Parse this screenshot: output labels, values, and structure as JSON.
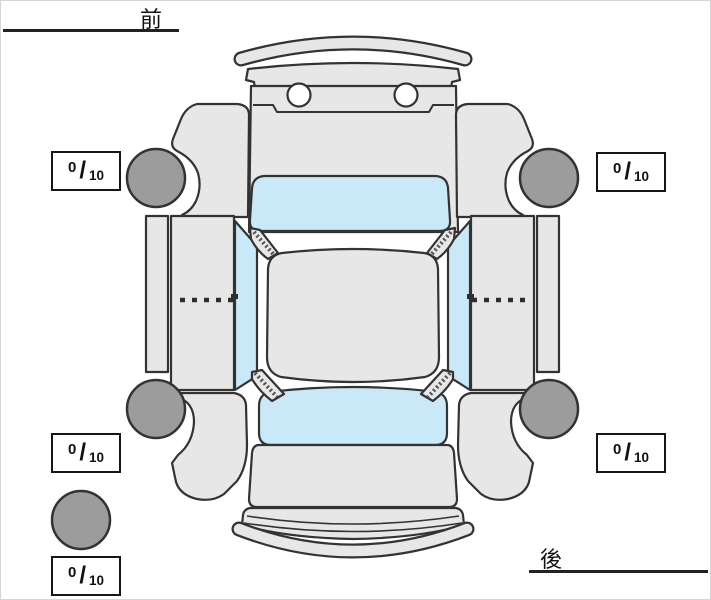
{
  "page": {
    "background": "#ffffff"
  },
  "orientation_labels": {
    "front": "前",
    "rear": "後"
  },
  "tire_scores": {
    "front_left": {
      "value": "0",
      "separator": "/",
      "max": "10"
    },
    "front_right": {
      "value": "0",
      "separator": "/",
      "max": "10"
    },
    "rear_left": {
      "value": "0",
      "separator": "/",
      "max": "10"
    },
    "rear_right": {
      "value": "0",
      "separator": "/",
      "max": "10"
    },
    "spare": {
      "value": "0",
      "separator": "/",
      "max": "10"
    }
  },
  "colors": {
    "background": "#ffffff",
    "body": "#e7e7e7",
    "glass": "#c9e8f8",
    "tire": "#9c9c9c",
    "outline": "#333333",
    "box_border": "#161616",
    "label_text": "#111111",
    "underline": "#222222",
    "seam": "#555555"
  },
  "icons": {
    "diagram": "car-top-view-diagram",
    "wheel": "tire-circle",
    "spare": "spare-tire-circle"
  }
}
